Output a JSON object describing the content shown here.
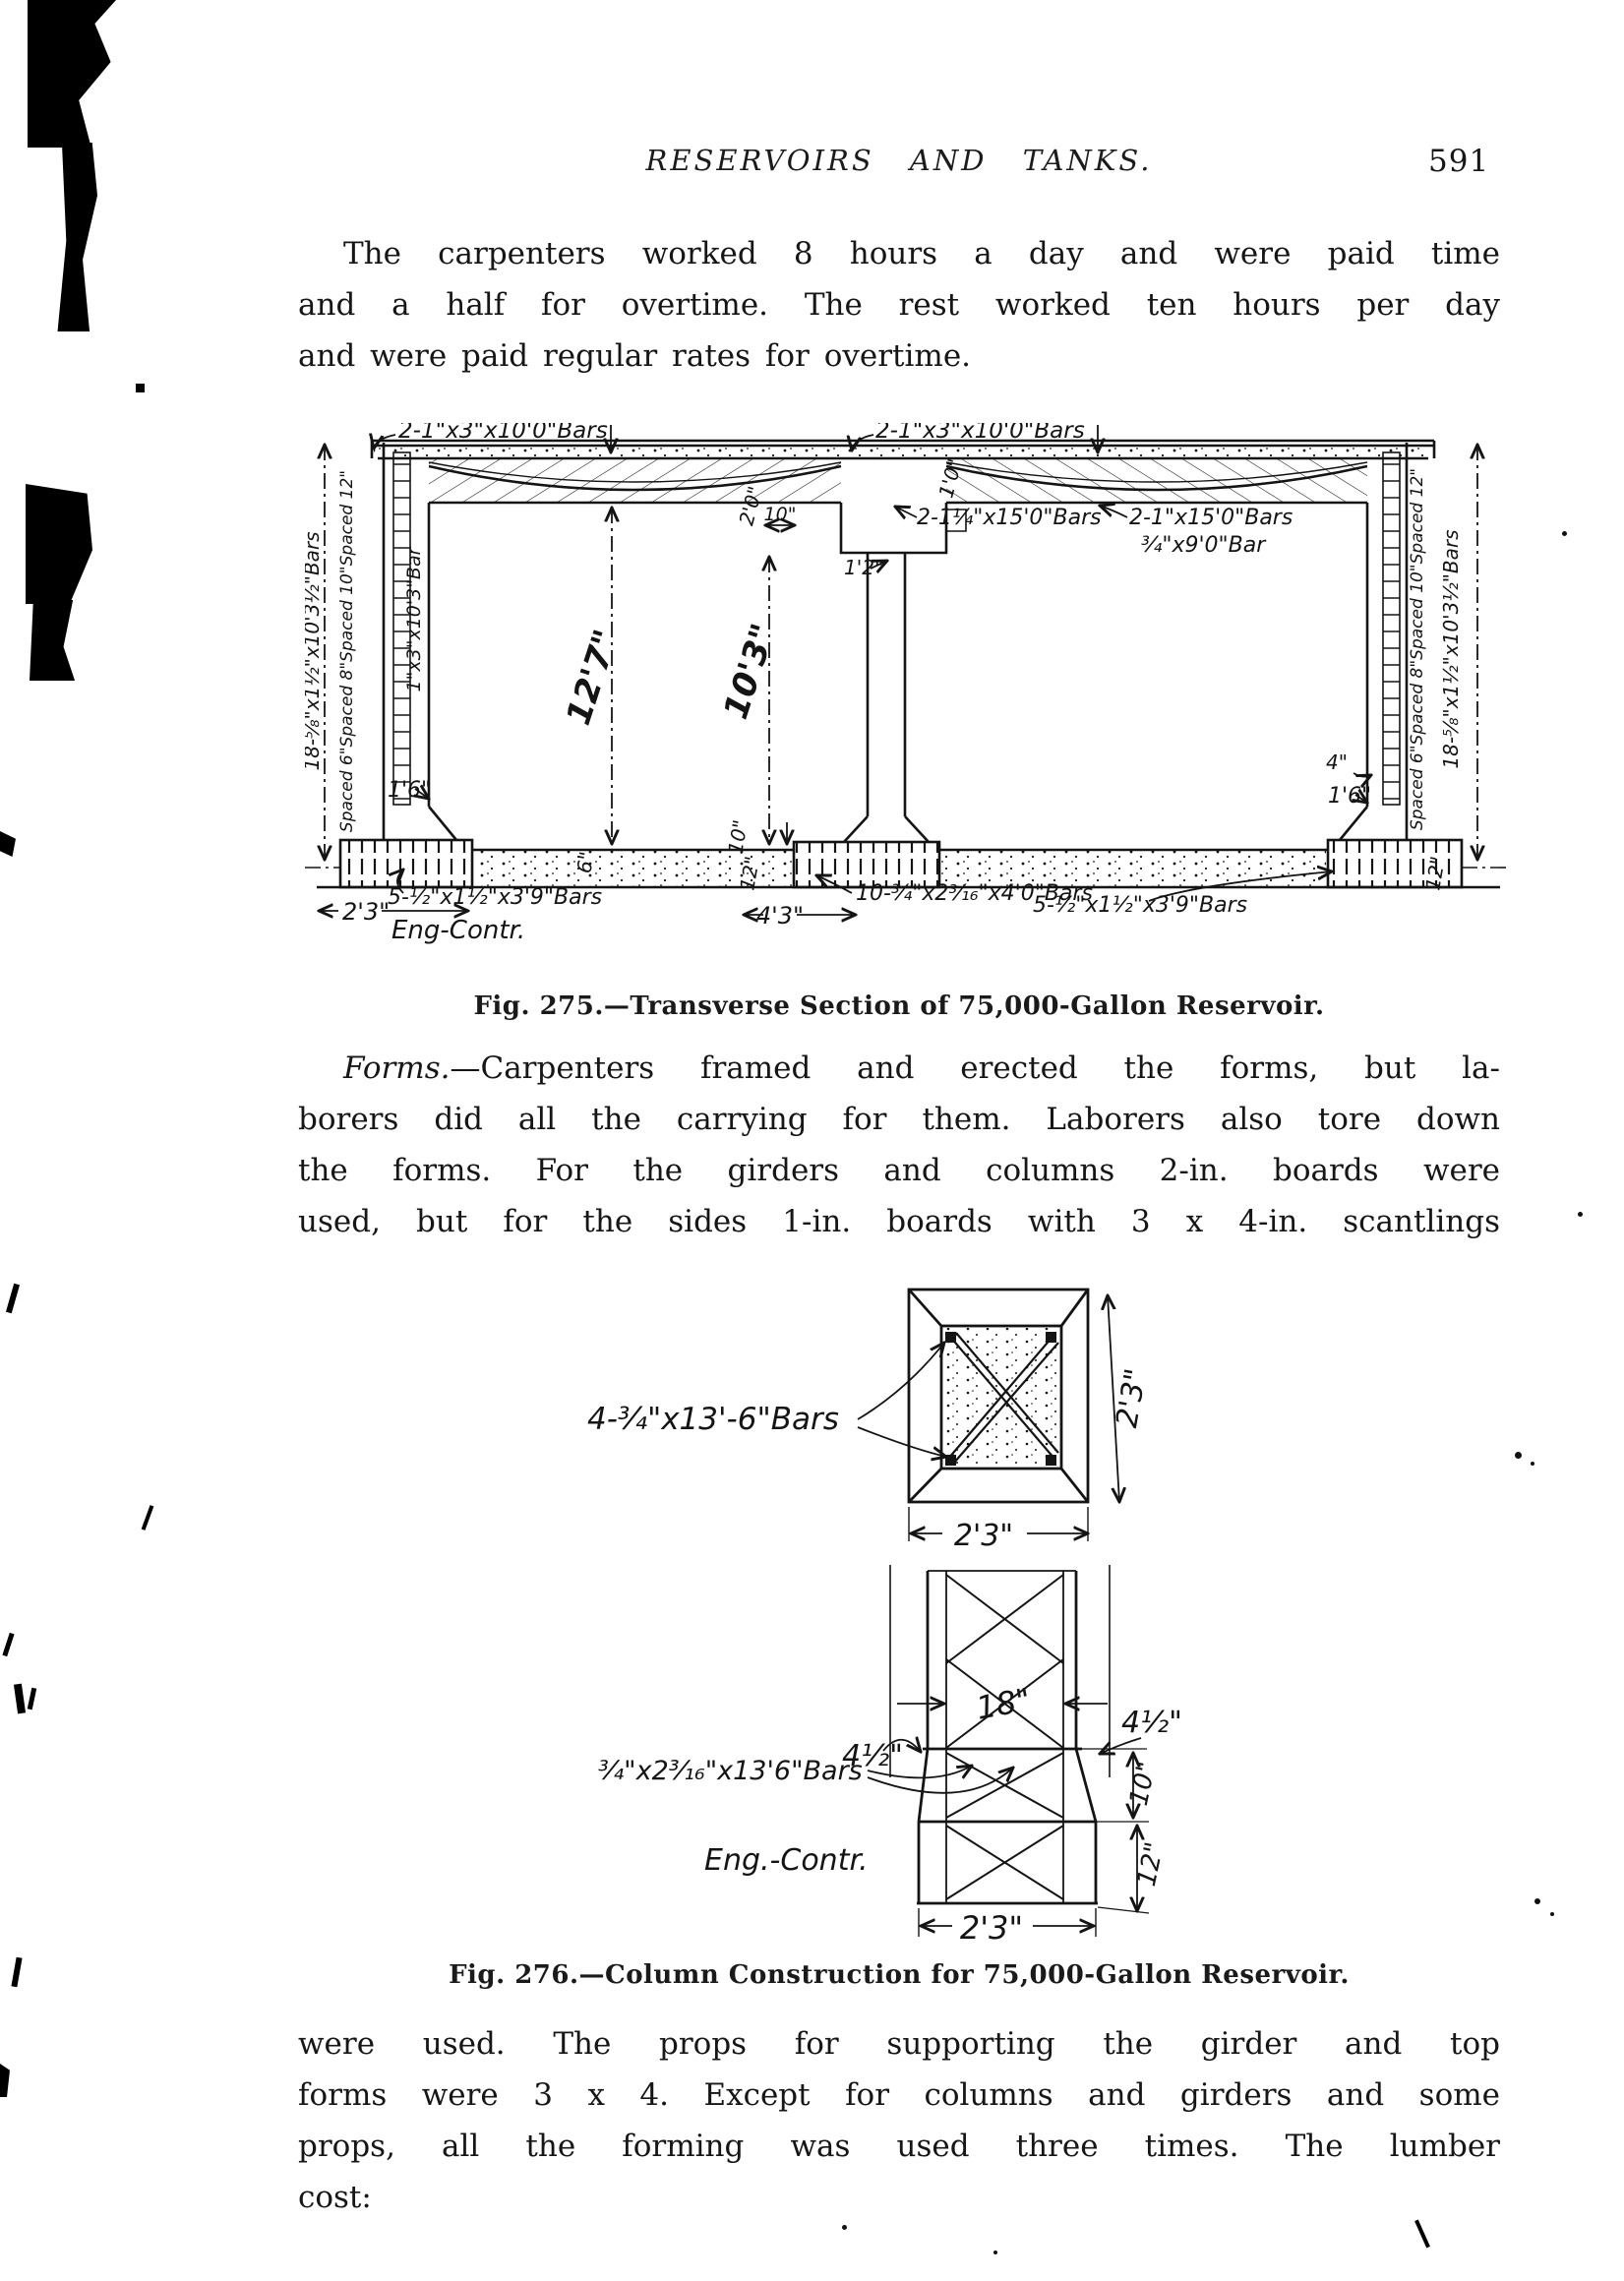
{
  "header": {
    "title": "RESERVOIRS AND TANKS.",
    "page_number": "591"
  },
  "p1": {
    "lines": [
      "The carpenters worked 8 hours a day and were paid time",
      "and a half for overtime.  The rest worked ten hours per day",
      "and were paid regular rates for overtime."
    ]
  },
  "fig275": {
    "caption": "Fig. 275.—Transverse Section of 75,000-Gallon Reservoir.",
    "top_bars_left": "2-1\"x3\"x10'0\"Bars",
    "top_bars_right": "2-1\"x3\"x10'0\"Bars",
    "girder_bars_left": "2-1¼\"x15'0\"Bars",
    "girder_bars_right": "2-1\"x15'0\"Bars",
    "girder_bar_small": "¾\"x9'0\"Bar",
    "wall_bars_left": "18-⅝\"x1½\"x10'3½\"Bars",
    "wall_spacing_left": "Spaced 6\"Spaced 8\"Spaced 10\"Spaced 12\"",
    "wall_bar_inner": "1\"x3\"x10'3\"Bar",
    "wall_bars_right": "18-⅝\"x1½\"x10'3½\"Bars",
    "wall_spacing_right": "Spaced 6\"Spaced 8\"Spaced 10\"Spaced 12\"",
    "dim_bay_left": "12'7\"",
    "dim_bay_right": "10'3\"",
    "dim_wall_left": "1'6\"",
    "dim_wall_right": "1'6\"",
    "dim_right_small": "4\"",
    "dim_haunch": "2'0\"",
    "dim_haunch_b": "1'0\"",
    "dim_step": "10\"",
    "dim_girder": "1'2\"",
    "dim_slab": "6\"",
    "dim_col_base": "10\"",
    "dim_footing_depth": "12\"",
    "dim_footing_right": "12\"",
    "dim_footing_left_w": "2'3\"",
    "dim_footing_center_w": "4'3\"",
    "footing_bars_left": "5-½\"x1½\"x3'9\"Bars",
    "footing_bars_center": "10-¾\"x2³⁄₁₆\"x4'0\"Bars",
    "footing_bars_right": "5-½\"x1½\"x3'9\"Bars",
    "credit": "Eng-Contr."
  },
  "p2": {
    "lead": "Forms.",
    "lead_rest": "—Carpenters framed and erected the forms, but la-",
    "lines": [
      "borers did all the carrying for them.  Laborers also tore down",
      "the forms.  For the girders and columns 2-in. boards were",
      "used, but for the sides 1-in. boards with 3 x 4-in. scantlings"
    ]
  },
  "fig276": {
    "caption": "Fig. 276.—Column Construction for 75,000-Gallon Reservoir.",
    "section_bars": "4-¾\"x13'-6\"Bars",
    "section_dim_right": "2'3\"",
    "section_dim_bottom": "2'3\"",
    "col_width": "18\"",
    "offset_left": "4½\"",
    "offset_right": "4½\"",
    "splay_bars": "¾\"x2³⁄₁₆\"x13'6\"Bars",
    "dim_splay": "10\"",
    "dim_base": "12\"",
    "base_width": "2'3\"",
    "credit": "Eng.-Contr."
  },
  "p3": {
    "lines": [
      "were used.  The props for supporting the girder and top",
      "forms were 3 x 4.  Except for columns and girders and some",
      "props, all the forming was used three times.  The lumber",
      "cost:"
    ]
  }
}
